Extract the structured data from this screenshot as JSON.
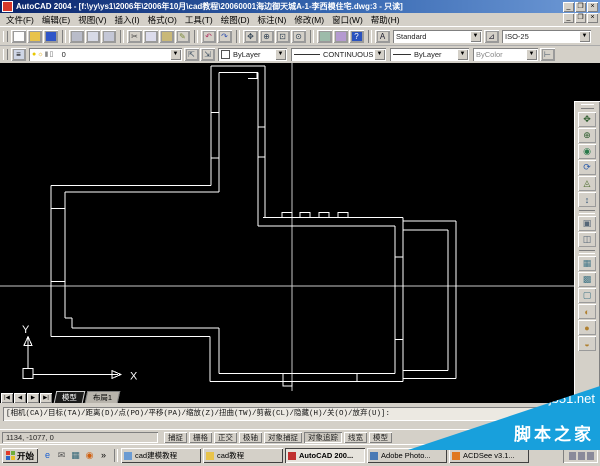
{
  "titlebar": {
    "title": "AutoCAD 2004 - [f:\\yy\\ys1\\2006年\\2006年10月\\cad教程\\20060001海边御天城A-1-李西模住宅.dwg:3 - 只读]",
    "minimize": "_",
    "restore": "❐",
    "close": "×"
  },
  "menubar": {
    "items": [
      {
        "name": "menu-file",
        "label": "文件(F)"
      },
      {
        "name": "menu-edit",
        "label": "编辑(E)"
      },
      {
        "name": "menu-view",
        "label": "视图(V)"
      },
      {
        "name": "menu-insert",
        "label": "插入(I)"
      },
      {
        "name": "menu-format",
        "label": "格式(O)"
      },
      {
        "name": "menu-tools",
        "label": "工具(T)"
      },
      {
        "name": "menu-draw",
        "label": "绘图(D)"
      },
      {
        "name": "menu-dimension",
        "label": "标注(N)"
      },
      {
        "name": "menu-modify",
        "label": "修改(M)"
      },
      {
        "name": "menu-window",
        "label": "窗口(W)"
      },
      {
        "name": "menu-help",
        "label": "帮助(H)"
      }
    ],
    "child_minimize": "_",
    "child_restore": "❐",
    "child_close": "×"
  },
  "toolbar_standard": {
    "icons": [
      {
        "name": "new-file-icon",
        "glyph": "",
        "bg": "#fdfdfd"
      },
      {
        "name": "open-folder-icon",
        "glyph": "",
        "bg": "#e8c34a"
      },
      {
        "name": "save-icon",
        "glyph": "",
        "bg": "#2f55c8"
      },
      {
        "sep": true
      },
      {
        "name": "plot-icon",
        "glyph": "",
        "bg": "#b9bcc9"
      },
      {
        "name": "plot-preview-icon",
        "glyph": "",
        "bg": "#d7dae6"
      },
      {
        "name": "publish-icon",
        "glyph": "",
        "bg": "#c4c7d6"
      },
      {
        "sep": true
      },
      {
        "name": "cut-icon",
        "glyph": "✂",
        "fg": "#444"
      },
      {
        "name": "copy-icon",
        "glyph": "",
        "bg": "#dcdcec"
      },
      {
        "name": "paste-icon",
        "glyph": "",
        "bg": "#c9b878"
      },
      {
        "name": "match-properties-icon",
        "glyph": "✎",
        "fg": "#7a8a3a"
      },
      {
        "sep": true
      },
      {
        "name": "undo-icon",
        "glyph": "↶",
        "fg": "#b03060"
      },
      {
        "name": "redo-icon",
        "glyph": "↷",
        "fg": "#3050b0"
      },
      {
        "sep": true
      },
      {
        "name": "pan-icon",
        "glyph": "✥",
        "fg": "#334455"
      },
      {
        "name": "zoom-realtime-icon",
        "glyph": "⊕",
        "fg": "#334455"
      },
      {
        "name": "zoom-window-icon",
        "glyph": "⊡",
        "fg": "#334455"
      },
      {
        "name": "zoom-previous-icon",
        "glyph": "⊙",
        "fg": "#334455"
      },
      {
        "sep": true
      },
      {
        "name": "properties-icon",
        "glyph": "",
        "bg": "#9dbbaa"
      },
      {
        "name": "designcenter-icon",
        "glyph": "",
        "bg": "#b49ad0"
      },
      {
        "name": "help-icon",
        "glyph": "?",
        "fg": "#ffffff",
        "bg": "#2a52be"
      }
    ],
    "text_style_value": "Standard",
    "dim_style_value": "ISO-25"
  },
  "toolbar_properties": {
    "layer_name": "0",
    "layer_icons": [
      {
        "name": "layer-on-bulb-icon",
        "glyph": "●",
        "fg": "#e8c800"
      },
      {
        "name": "layer-freeze-sun-icon",
        "glyph": "☼",
        "fg": "#d8a000"
      },
      {
        "name": "layer-lock-icon",
        "glyph": "▮",
        "fg": "#8a8a8a"
      },
      {
        "name": "layer-plot-icon",
        "glyph": "▯",
        "fg": "#666666"
      },
      {
        "name": "layer-color-swatch",
        "glyph": "■",
        "fg": "#ffffff"
      }
    ],
    "make-current-glyph": "⇱",
    "previous-layer-glyph": "⇲",
    "color_value": "ByLayer",
    "linetype_value": "CONTINUOUS",
    "lineweight_value": "ByLayer",
    "plotstyle_value": "ByColor"
  },
  "right_toolbar": {
    "icons": [
      {
        "name": "orbit-pan-icon",
        "glyph": "✥",
        "fg": "#2a5a2a"
      },
      {
        "name": "orbit-zoom-icon",
        "glyph": "⊕",
        "fg": "#2a5a2a"
      },
      {
        "name": "orbit-3d-icon",
        "glyph": "◉",
        "fg": "#2a7a4a"
      },
      {
        "name": "orbit-continuous-icon",
        "glyph": "⟳",
        "fg": "#2a5aaa"
      },
      {
        "name": "orbit-swivel-icon",
        "glyph": "◬",
        "fg": "#4a6a2a"
      },
      {
        "name": "adjust-distance-icon",
        "glyph": "↕",
        "fg": "#335577"
      },
      {
        "sep": true
      },
      {
        "name": "camera-icon",
        "glyph": "▣",
        "fg": "#556677"
      },
      {
        "name": "clipping-planes-icon",
        "glyph": "◫",
        "fg": "#556677"
      },
      {
        "sep": true
      },
      {
        "name": "wireframe-2d-icon",
        "glyph": "▦",
        "fg": "#447788"
      },
      {
        "name": "wireframe-3d-icon",
        "glyph": "▩",
        "fg": "#447788"
      },
      {
        "name": "hidden-shade-icon",
        "glyph": "▢",
        "fg": "#447788"
      },
      {
        "name": "flat-shaded-icon",
        "glyph": "◐",
        "fg": "#b08030"
      },
      {
        "name": "gouraud-shaded-icon",
        "glyph": "●",
        "fg": "#b08030"
      },
      {
        "name": "shaded-edges-icon",
        "glyph": "◒",
        "fg": "#b08030"
      }
    ]
  },
  "canvas": {
    "ucs_x_label": "X",
    "ucs_y_label": "Y"
  },
  "tabs": {
    "nav": [
      {
        "name": "tab-first-button",
        "glyph": "|◀"
      },
      {
        "name": "tab-prev-button",
        "glyph": "◀"
      },
      {
        "name": "tab-next-button",
        "glyph": "▶"
      },
      {
        "name": "tab-last-button",
        "glyph": "▶|"
      }
    ],
    "items": [
      {
        "name": "tab-model",
        "label": "模型",
        "active": true
      },
      {
        "name": "tab-layout1",
        "label": "布局1"
      }
    ]
  },
  "command": {
    "options_line": "[相机(CA)/目标(TA)/距离(D)/点(PO)/平移(PA)/缩放(Z)/扭曲(TW)/剪裁(CL)/隐藏(H)/关(O)/放弃(U)]:"
  },
  "statusbar": {
    "coords": "1134, -1077, 0",
    "toggles": [
      {
        "name": "toggle-snap",
        "label": "捕捉"
      },
      {
        "name": "toggle-grid",
        "label": "栅格"
      },
      {
        "name": "toggle-ortho",
        "label": "正交"
      },
      {
        "name": "toggle-polar",
        "label": "极轴"
      },
      {
        "name": "toggle-osnap",
        "label": "对象捕捉"
      },
      {
        "name": "toggle-otrack",
        "label": "对象追踪",
        "pressed": true
      },
      {
        "name": "toggle-lineweight",
        "label": "线宽"
      },
      {
        "name": "toggle-model-space",
        "label": "模型"
      }
    ]
  },
  "taskbar": {
    "start_label": "开始",
    "quick_launch": [
      {
        "name": "ie-icon",
        "glyph": "e",
        "fg": "#1a5fd0"
      },
      {
        "name": "outlook-icon",
        "glyph": "✉",
        "fg": "#555555"
      },
      {
        "name": "show-desktop-icon",
        "glyph": "▦",
        "fg": "#336677"
      },
      {
        "name": "media-player-icon",
        "glyph": "◉",
        "fg": "#d06010"
      },
      {
        "name": "quick-launch-overflow",
        "glyph": "»",
        "fg": "#000000"
      }
    ],
    "tasks": [
      {
        "name": "task-cad-modeling-folder",
        "label": "cad建模教程",
        "color": "#6b9bd2"
      },
      {
        "name": "task-cad-folder",
        "label": "cad教程",
        "color": "#e8c34a"
      },
      {
        "name": "task-autocad",
        "label": "AutoCAD 200...",
        "color": "#c03030",
        "active": true
      },
      {
        "name": "task-photoshop",
        "label": "Adobe Photo...",
        "color": "#4a7ab5"
      },
      {
        "name": "task-acdsee",
        "label": "ACDSee v3.1...",
        "color": "#e07820"
      }
    ]
  },
  "watermark": {
    "site": "jb51.net",
    "site_name": "脚本之家",
    "color": "#18a0dc"
  }
}
